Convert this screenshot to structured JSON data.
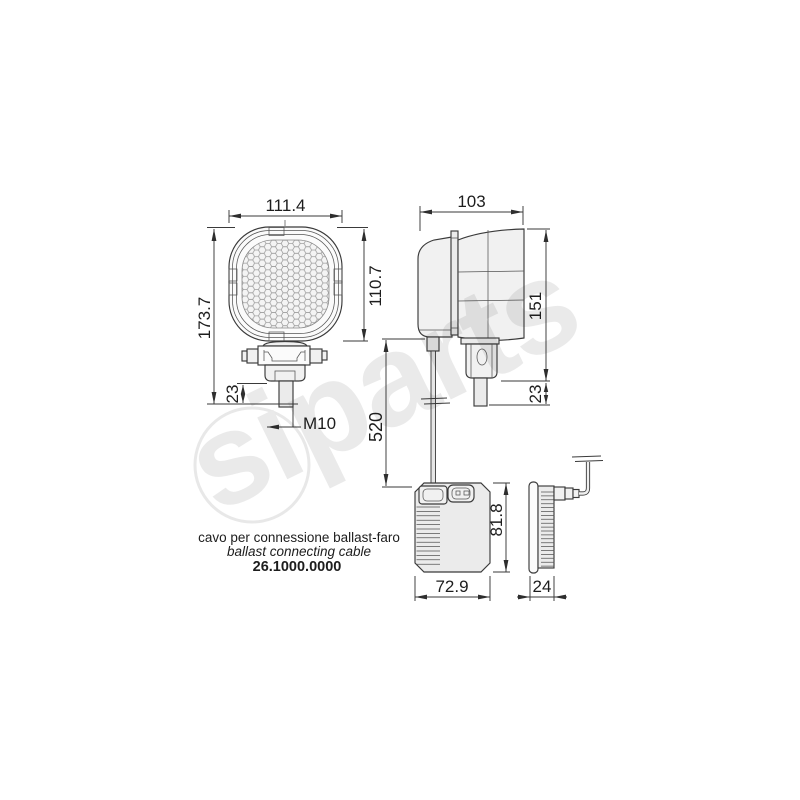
{
  "drawing_title": "work lamp with ballast - dimensional drawing",
  "dimensions": {
    "front_width": "111.4",
    "lens_height": "110.7",
    "total_height": "173.7",
    "front_stud": "23",
    "thread": "M10",
    "side_depth": "103",
    "side_height": "151",
    "side_stud": "23",
    "cable_length": "520",
    "ballast_width": "72.9",
    "ballast_height": "81.8",
    "ballast_depth": "24"
  },
  "caption": {
    "line_it": "cavo per connessione ballast-faro",
    "line_en": "ballast connecting cable",
    "part_number": "26.1000.0000",
    "part_number_color": "#b5443f"
  },
  "watermark": {
    "text": "siparts"
  }
}
